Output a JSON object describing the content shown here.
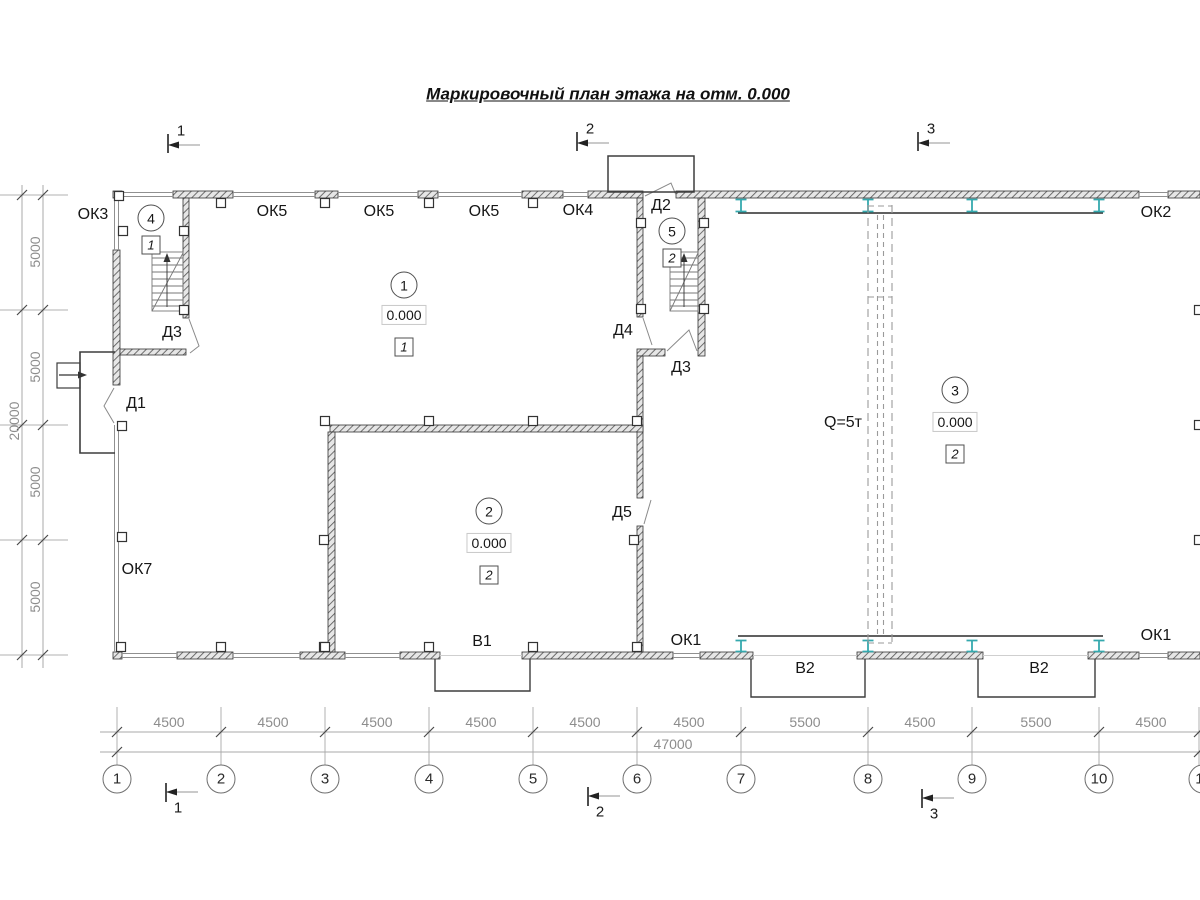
{
  "title": "Маркировочный план этажа на отм. 0.000",
  "section_markers": {
    "s1": "1",
    "s2": "2",
    "s3": "3"
  },
  "grid": {
    "columns": [
      "1",
      "2",
      "3",
      "4",
      "5",
      "6",
      "7",
      "8",
      "9",
      "10",
      "11"
    ]
  },
  "dimensions": {
    "spans_bottom": [
      "4500",
      "4500",
      "4500",
      "4500",
      "4500",
      "4500",
      "5500",
      "4500",
      "5500",
      "4500"
    ],
    "total_bottom": "47000",
    "spans_left": [
      "5000",
      "5000",
      "5000",
      "5000"
    ],
    "total_left": "20000"
  },
  "rooms": {
    "r1": {
      "number": "1",
      "elevation": "0.000",
      "floor_type": "1"
    },
    "r2": {
      "number": "2",
      "elevation": "0.000",
      "floor_type": "2"
    },
    "r3": {
      "number": "3",
      "elevation": "0.000",
      "floor_type": "2"
    },
    "r4": {
      "number": "4",
      "floor_type": "1"
    },
    "r5": {
      "number": "5",
      "floor_type": "2"
    }
  },
  "openings": {
    "ok1": "ОК1",
    "ok2": "ОК2",
    "ok3": "ОК3",
    "ok4": "ОК4",
    "ok5": "ОК5",
    "ok7": "ОК7",
    "d1": "Д1",
    "d2": "Д2",
    "d3": "Д3",
    "d4": "Д4",
    "d5": "Д5",
    "v1": "В1",
    "v2": "В2"
  },
  "crane": {
    "capacity": "Q=5т"
  },
  "colors": {
    "crane_column": "#35a9ae"
  }
}
